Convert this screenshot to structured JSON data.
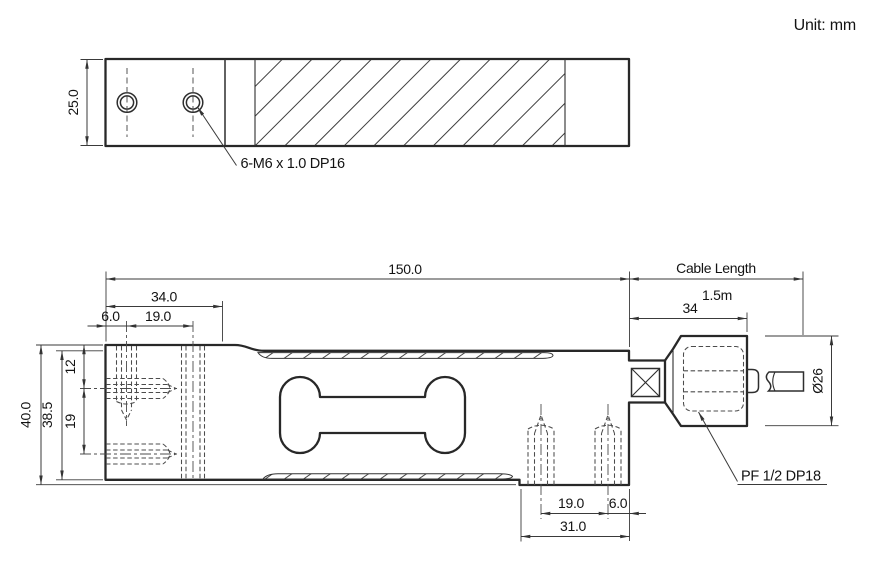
{
  "meta": {
    "unit_label": "Unit: mm"
  },
  "colors": {
    "line": "#2b2b2b",
    "dim": "#3d3d3d",
    "text": "#161616",
    "background": "#ffffff"
  },
  "top_view": {
    "height_dim": "25.0",
    "thread_callout": "6-M6 x 1.0 DP16"
  },
  "side_view": {
    "overall_length": "150.0",
    "cable_length_label": "Cable Length",
    "cable_length_value": "1.5m",
    "connector_width": "34",
    "mount_length": "34.0",
    "edge_offset": "6.0",
    "hole_pitch": "19.0",
    "total_height": "40.0",
    "inner_height": "38.5",
    "top_to_axis": "12",
    "axis_pitch": "19",
    "bottom_pitch": "19.0",
    "bottom_edge_offset": "6.0",
    "bottom_section": "31.0",
    "connector_dia": "Ø26",
    "fitting_callout": "PF 1/2  DP18"
  }
}
